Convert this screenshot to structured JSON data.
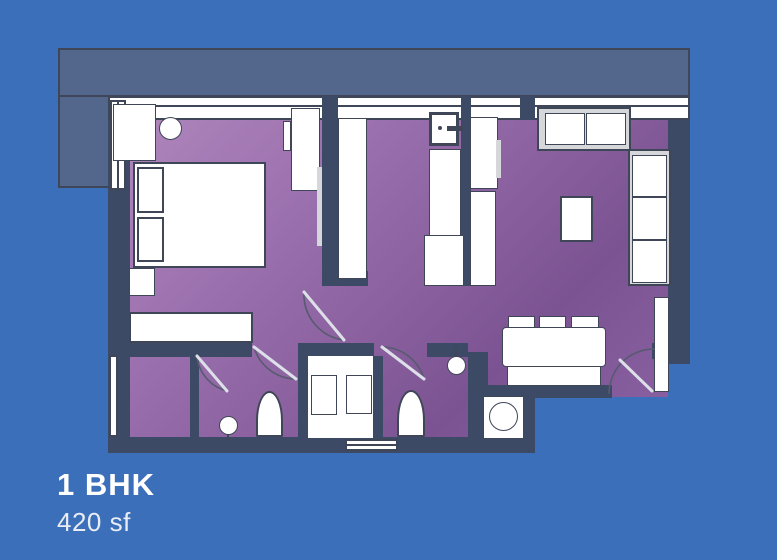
{
  "card": {
    "title": "1 BHK",
    "area": "420 sf"
  },
  "colors": {
    "background": "#3b6fba",
    "terrace": "#53668c",
    "wall": "#3d4a66",
    "floor_light": "#b086bc",
    "floor_dark": "#7c5392",
    "furniture": "#ffffff",
    "outline": "#3f4658",
    "frame": "#d5d7db",
    "text": "#ffffff"
  }
}
